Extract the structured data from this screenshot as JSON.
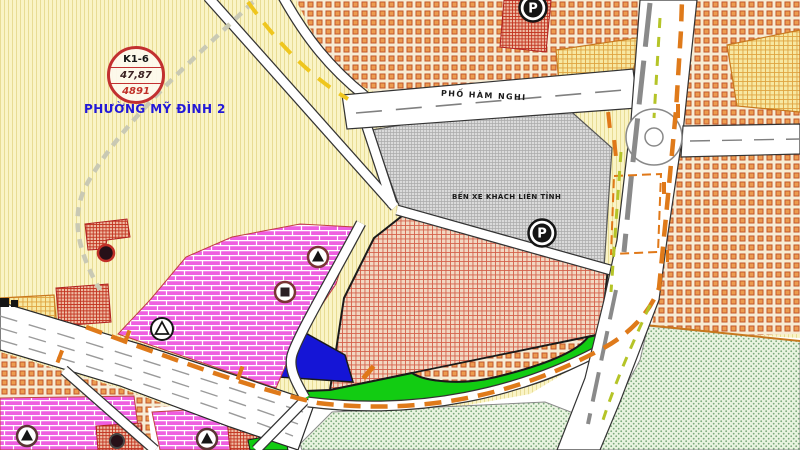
{
  "map": {
    "stamp": {
      "line1": "K1-6",
      "line2": "47,87",
      "line3": "4891"
    },
    "labels": {
      "ward": "PHƯỜNG MỸ ĐÌNH 2",
      "street": "PHỐ HÀM NGHI",
      "bus_station": "BẾN XE KHÁCH LIÊN TỈNH",
      "parking": "P"
    },
    "colors": {
      "ward_label_blue": "#2218D8",
      "stamp_red": "#C23030",
      "residential_orange": "#EC9C50",
      "mixed_use_pink": "#EE5FE0",
      "public_red_hatch": "#D4604A",
      "bus_station_gray": "#DADADA",
      "park_bright_green": "#12CC12",
      "water_blue": "#1515D6",
      "lawn_light_green": "#E9F4E0",
      "boundary_orange_dash": "#DF7A1A",
      "boundary_yellow_dash": "#EFC61E"
    },
    "markers": [
      "parking-icon",
      "parking-icon",
      "triangle-station-icon",
      "triangle-station-icon",
      "triangle-station-icon",
      "triangle-station-icon",
      "square-station-icon",
      "temple-dot-icon",
      "temple-dot-icon"
    ]
  }
}
